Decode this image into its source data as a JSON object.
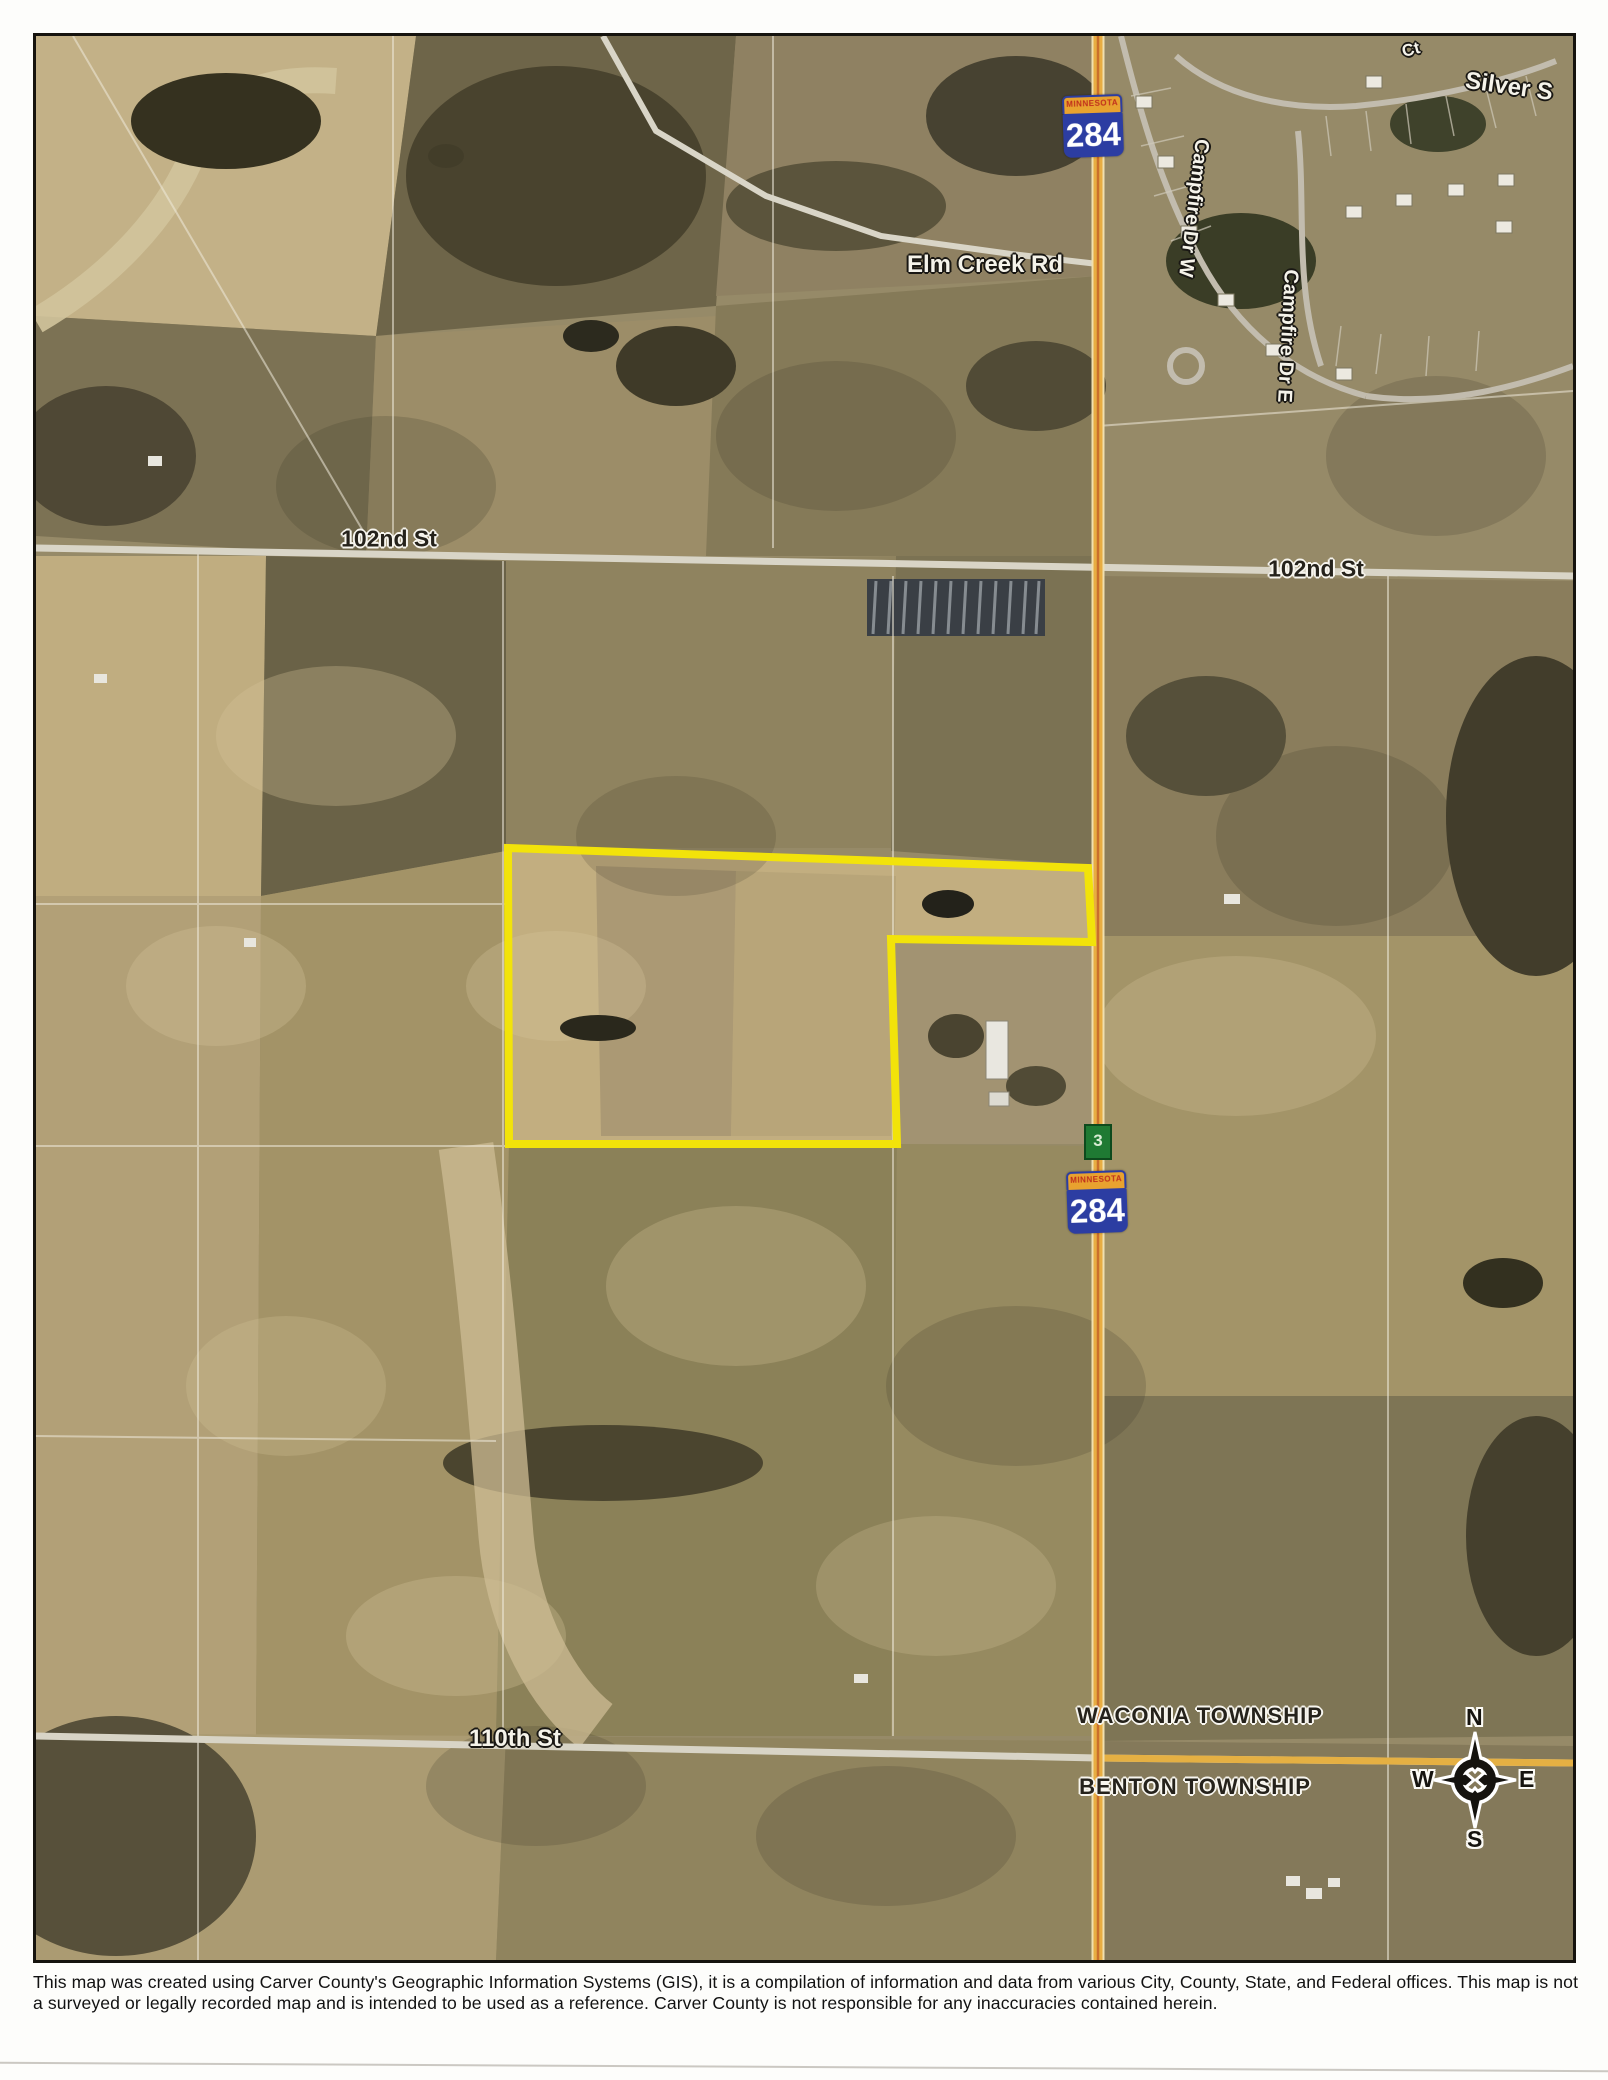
{
  "document": {
    "disclaimer": "This map was created using Carver County's Geographic Information Systems (GIS), it is a compilation of information and data from various City, County, State, and Federal offices. This map is not a surveyed or legally recorded map and is intended to be used as a reference. Carver County is not responsible for any inaccuracies contained herein."
  },
  "map": {
    "road_labels": {
      "elm_creek_rd": "Elm Creek Rd",
      "street_102_left": "102nd St",
      "street_102_right": "102nd St",
      "street_110": "110th St",
      "campfire_dr_w": "Campfire Dr W",
      "campfire_dr_e": "Campfire Dr E",
      "silver_partial": "Silver S",
      "top_edge_partial": "Ct"
    },
    "township_labels": {
      "north": "WACONIA TOWNSHIP",
      "south": "BENTON TOWNSHIP"
    },
    "highway_shield": {
      "banner": "MINNESOTA",
      "number": "284"
    },
    "mile_marker": "3",
    "compass": {
      "north": "N",
      "south": "S",
      "east": "E",
      "west": "W"
    },
    "colors": {
      "parcel_outline": "#f2e30a",
      "highway": "#e8ad42",
      "highway_center": "#c96f2c",
      "road": "#d9d5c7",
      "shield_blue": "#2c3da2",
      "shield_banner": "#e8a22f"
    }
  }
}
